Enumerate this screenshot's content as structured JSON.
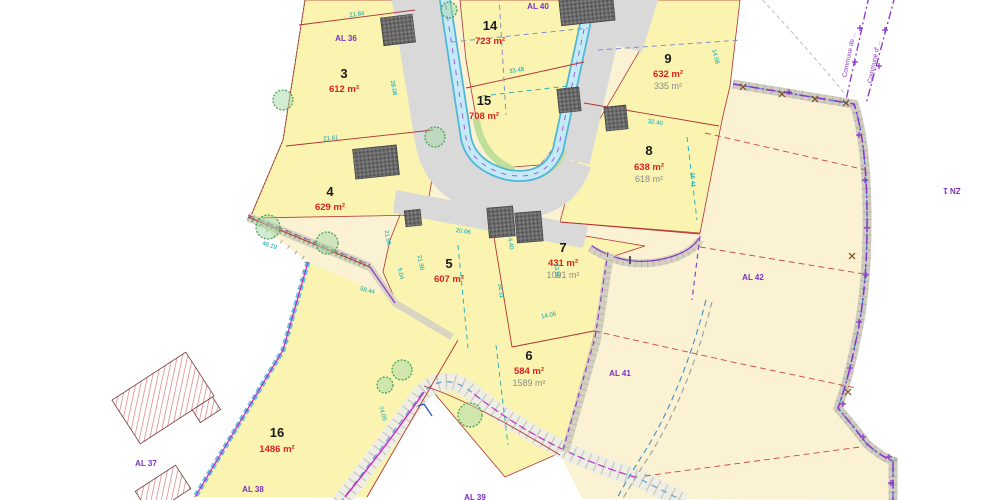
{
  "map": {
    "type": "cadastral-subdivision-plan",
    "colors": {
      "lot_fill": "#FAF4B0",
      "outer_parcel_fill": "#FAF2D2",
      "road_fill": "#D9D9D9",
      "water_channel": "#C6E9F6",
      "boundary_red": "#B33334",
      "ref_purple": "#7B2FBE",
      "dimension_cyan": "#00A0B0",
      "area_red": "#DD2222"
    },
    "lots": [
      {
        "number": "3",
        "area": "612 m²"
      },
      {
        "number": "4",
        "area": "629 m²"
      },
      {
        "number": "5",
        "area": "607 m²"
      },
      {
        "number": "6",
        "area": "584 m²",
        "area2": "1589 m²"
      },
      {
        "number": "7",
        "area": "431 m²",
        "area2": "1091 m²"
      },
      {
        "number": "8",
        "area": "638 m²",
        "area2": "618 m²"
      },
      {
        "number": "9",
        "area": "632 m²",
        "area2": "335 m²"
      },
      {
        "number": "14",
        "area": "723 m²"
      },
      {
        "number": "15",
        "area": "708 m²"
      },
      {
        "number": "16",
        "area": "1486 m²"
      }
    ],
    "cadastral_refs": [
      {
        "label": "AL 36"
      },
      {
        "label": "AL 40"
      },
      {
        "label": "AL 37"
      },
      {
        "label": "AL 38"
      },
      {
        "label": "AL 41"
      },
      {
        "label": "AL 42"
      },
      {
        "label": "ZN 1"
      },
      {
        "label": "AL 39"
      }
    ],
    "boundary_labels": [
      {
        "label": "Commune de ..."
      },
      {
        "label": "Commune d' ..."
      }
    ],
    "dimensions": [
      {
        "text": "21.84"
      },
      {
        "text": "21.61"
      },
      {
        "text": "28.08"
      },
      {
        "text": "33.48"
      },
      {
        "text": "14.68"
      },
      {
        "text": "32.40"
      },
      {
        "text": "36.41"
      },
      {
        "text": "20.06"
      },
      {
        "text": "4.40"
      },
      {
        "text": "21.96"
      },
      {
        "text": "48.19"
      },
      {
        "text": "5.04"
      },
      {
        "text": "58.44"
      },
      {
        "text": "34.31"
      },
      {
        "text": "33.06"
      },
      {
        "text": "14.06"
      },
      {
        "text": "74.05"
      },
      {
        "text": "21.90"
      }
    ]
  }
}
